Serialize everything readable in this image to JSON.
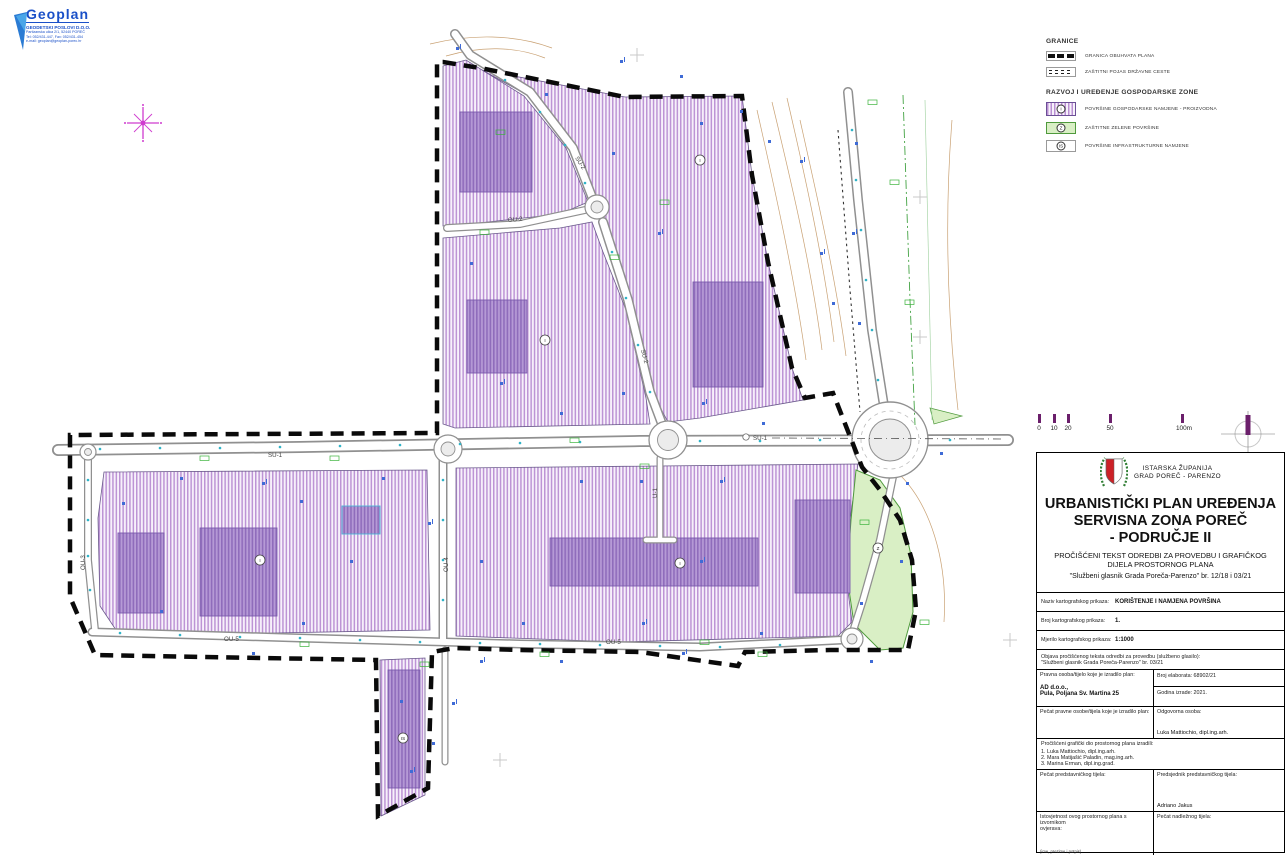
{
  "logo": {
    "name": "Geoplan",
    "subtitle": "GEODETSKI POSLOVI D.O.O.",
    "address_lines": [
      "Partizanska ulica 2/1, 52440 POREČ",
      "Tel: 052/431-447, Fax: 052/431-454",
      "e-mail: geoplan@geoplan-porec.hr"
    ]
  },
  "legend": {
    "granice_heading": "GRANICE",
    "granice_items": [
      {
        "label": "GRANICA OBUHVATA PLANA"
      },
      {
        "label": "ZAŠTITNI POJAS DRŽAVNE CESTE"
      }
    ],
    "zone_heading": "RAZVOJ I UREĐENJE GOSPODARSKE ZONE",
    "zone_items": [
      {
        "symbol": "I",
        "label": "POVRŠINE GOSPODARSKE NAMJENE - PROIZVODNA"
      },
      {
        "symbol": "Z",
        "label": "ZAŠTITNE ZELENE POVRŠINE"
      },
      {
        "symbol": "IS",
        "label": "POVRŠINE INFRASTRUKTURNE NAMJENE"
      }
    ]
  },
  "scalebar": {
    "ticks": [
      "0",
      "10",
      "20",
      "50",
      "100m"
    ]
  },
  "titleblock": {
    "county": "ISTARSKA ŽUPANIJA",
    "city": "GRAD POREČ - PARENZO",
    "title_line1": "URBANISTIČKI PLAN UREĐENJA",
    "title_line2": "SERVISNA ZONA POREČ",
    "title_line3": "- PODRUČJE II",
    "subtitle_line1": "PROČIŠĆENI TEKST ODREDBI ZA PROVEDBU I GRAFIČKOG",
    "subtitle_line2": "DIJELA PROSTORNOG PLANA",
    "gazette": "\"Službeni glasnik Grada Poreča-Parenzo\" br. 12/18 i 03/21",
    "rows": {
      "naziv_label": "Naziv kartografskog prikaza:",
      "naziv_value": "KORIŠTENJE I NAMJENA POVRŠINA",
      "broj_label": "Broj kartografskog prikaza:",
      "broj_value": "1.",
      "mjerilo_label": "Mjerilo kartografskog prikaza:",
      "mjerilo_value": "1:1000",
      "objava_label": "Objava pročišćenog teksta odredbi za provedbu (službeno glasilo):",
      "objava_value": "\"Službeni glasnik Grada Poreča-Parenzo\" br. 03/21",
      "pravna_label": "Pravna osoba/tijelo koje je izradilo plan:",
      "pravna_value1": "AD d.o.o.,",
      "pravna_value2": "Pula, Poljana Sv. Martina 25",
      "elaborat": "Broj elaborata: 68902/21",
      "godina": "Godina izrade: 2021.",
      "pecat_pravne_label": "Pečat pravne osobe/tijela koje je izradilo plan:",
      "odgovorna_label": "Odgovorna osoba:",
      "odgovorna_name": "Luka Mattiochio, dipl.ing.arh.",
      "izradili_label": "Pročišćeni grafički dio prostornog plana izradili:",
      "izradili_1": "1. Luka Mattiochio, dipl.ing.arh.",
      "izradili_2": "2. Mara Matijašić Paladin, mag.ing.arh.",
      "izradili_3": "3. Marina Erman, dipl.ing.građ.",
      "pecat_predst_label": "Pečat predstavničkog tijela:",
      "predsjednik_label": "Predsjednik predstavničkog tijela:",
      "predsjednik_name": "Adriano Jakus",
      "istovjetnost_label1": "Istovjetnost ovog prostornog plana s izvornikom",
      "istovjetnost_label2": "ovjerava:",
      "pecat_nadleznog_label": "Pečat nadležnog tijela:",
      "note": "(ime, prezime i potpis)"
    }
  },
  "map": {
    "colors": {
      "zone_hatch_purple": "#b98fd2",
      "building_purple": "#a98cc9",
      "green_zone": "#d9efc5",
      "boundary_black": "#0a0a0a",
      "road_casing": "#909090",
      "contour_brown": "#c9a173",
      "marker_blue": "#3f6bd6",
      "marker_cyan": "#2fb3c7",
      "marker_green": "#3cb43c",
      "north_star_magenta": "#cf3ccf",
      "scale_tick_purple": "#6b1f6b"
    },
    "road_labels": [
      {
        "text": "SU-1"
      },
      {
        "text": "SU-1"
      },
      {
        "text": "SU-2"
      },
      {
        "text": "SU-2"
      },
      {
        "text": "OU-2"
      },
      {
        "text": "OU-3"
      },
      {
        "text": "OU-4"
      },
      {
        "text": "OU-5"
      },
      {
        "text": "OU-5"
      },
      {
        "text": "U-1"
      }
    ],
    "zone_symbols": [
      {
        "symbol": "I"
      },
      {
        "symbol": "I"
      },
      {
        "symbol": "I"
      },
      {
        "symbol": "I"
      },
      {
        "symbol": "Z"
      },
      {
        "symbol": "IS"
      }
    ]
  }
}
